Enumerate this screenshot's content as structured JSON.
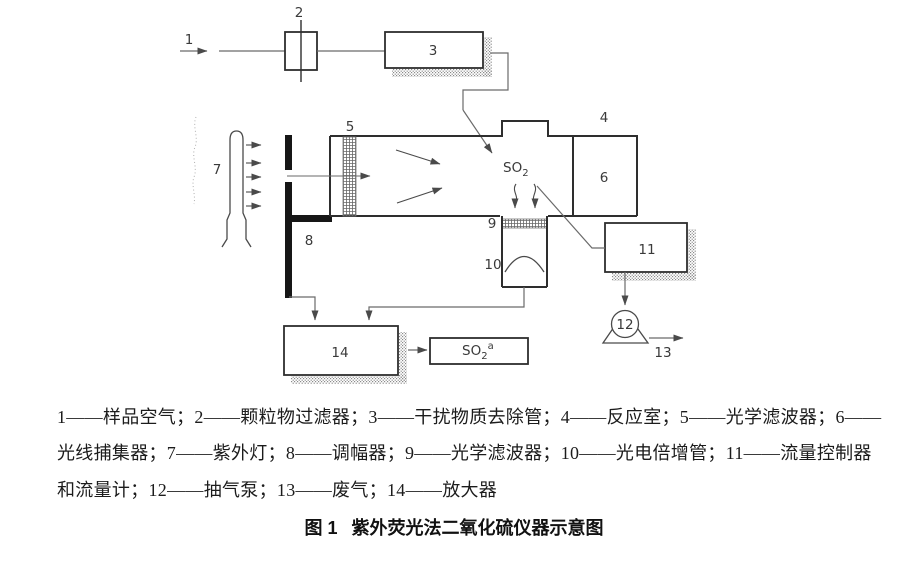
{
  "diagram": {
    "labels": {
      "n1": "1",
      "n2": "2",
      "n3": "3",
      "n4": "4",
      "n5": "5",
      "n6": "6",
      "n7": "7",
      "n8": "8",
      "n9": "9",
      "n10": "10",
      "n11": "11",
      "n12": "12",
      "n13": "13",
      "n14": "14"
    },
    "so2_chamber": {
      "base": "SO",
      "sub": "2"
    },
    "so2_output": {
      "base": "SO",
      "sub": "2",
      "sup": "a"
    }
  },
  "legend": {
    "line1": "1——样品空气；2——颗粒物过滤器；3——干扰物质去除管；4——反应室；5——光学滤波器；6——",
    "line2": "光线捕集器；7——紫外灯；8——调幅器；9——光学滤波器；10——光电倍增管；11——流量控制器",
    "line3": "和流量计；12——抽气泵；13——废气；14——放大器"
  },
  "caption": {
    "fig": "图 1",
    "title": "紫外荧光法二氧化硫仪器示意图"
  },
  "colors": {
    "ink": "#2e2e2e",
    "thin": "#6a6a6a",
    "background": "#ffffff"
  }
}
